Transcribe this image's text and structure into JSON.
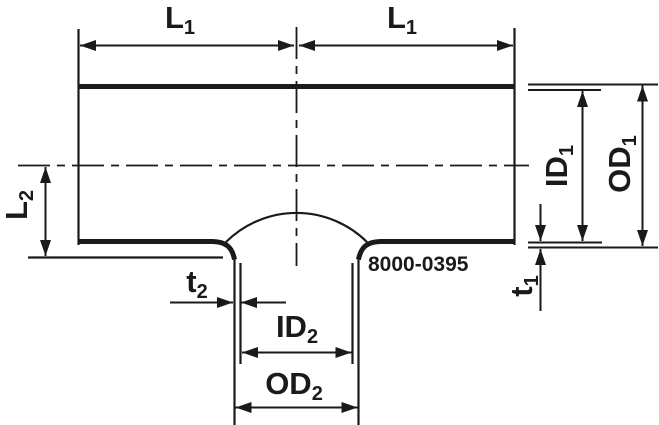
{
  "drawing": {
    "part_number": "8000-0395",
    "labels": {
      "l1_left": {
        "base": "L",
        "sub": "1"
      },
      "l1_right": {
        "base": "L",
        "sub": "1"
      },
      "l2": {
        "base": "L",
        "sub": "2"
      },
      "id1": {
        "base": "ID",
        "sub": "1"
      },
      "od1": {
        "base": "OD",
        "sub": "1"
      },
      "t1": {
        "base": "t",
        "sub": "1"
      },
      "t2": {
        "base": "t",
        "sub": "2"
      },
      "id2": {
        "base": "ID",
        "sub": "2"
      },
      "od2": {
        "base": "OD",
        "sub": "2"
      }
    },
    "colors": {
      "line": "#1a1a1a",
      "background": "#ffffff"
    }
  }
}
